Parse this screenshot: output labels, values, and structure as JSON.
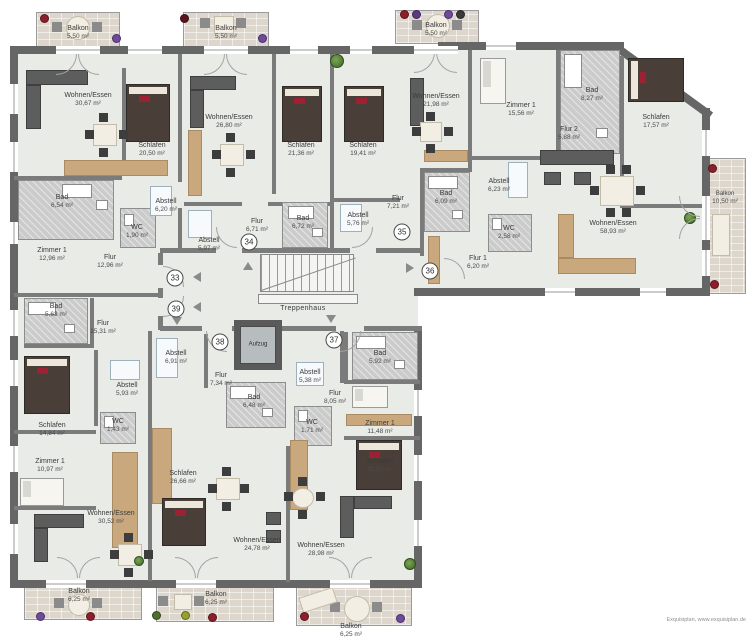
{
  "labels": {
    "stairwell": "Treppenhaus",
    "elevator": "Aufzug",
    "watermark": "Exquisiplan, www.exquisiplan.de"
  },
  "apartment_numbers": [
    "33",
    "39",
    "34",
    "35",
    "36",
    "38",
    "37"
  ],
  "rooms": [
    {
      "name": "Balkon",
      "area": "5,50 m²"
    },
    {
      "name": "Wohnen/Essen",
      "area": "30,67 m²"
    },
    {
      "name": "Schlafen",
      "area": "20,50 m²"
    },
    {
      "name": "Bad",
      "area": "6,54 m²"
    },
    {
      "name": "Zimmer 1",
      "area": "12,96 m²"
    },
    {
      "name": "Flur",
      "area": "12,96 m²"
    },
    {
      "name": "WC",
      "area": "1,90 m²"
    },
    {
      "name": "Abstell",
      "area": "6,20 m²"
    },
    {
      "name": "Balkon",
      "area": "5,50 m²"
    },
    {
      "name": "Wohnen/Essen",
      "area": "26,80 m²"
    },
    {
      "name": "Schlafen",
      "area": "21,36 m²"
    },
    {
      "name": "Abstell",
      "area": "5,97 m²"
    },
    {
      "name": "Flur",
      "area": "6,71 m²"
    },
    {
      "name": "Bad",
      "area": "6,72 m²"
    },
    {
      "name": "Balkon",
      "area": "5,50 m²"
    },
    {
      "name": "Schlafen",
      "area": "19,41 m²"
    },
    {
      "name": "Abstell",
      "area": "5,76 m²"
    },
    {
      "name": "Flur",
      "area": "7,21 m²"
    },
    {
      "name": "Wohnen/Essen",
      "area": "21,98 m²"
    },
    {
      "name": "Zimmer 1",
      "area": "15,56 m²"
    },
    {
      "name": "Bad",
      "area": "8,27 m²"
    },
    {
      "name": "Schlafen",
      "area": "17,57 m²"
    },
    {
      "name": "Flur 2",
      "area": "5,88 m²"
    },
    {
      "name": "Abstell",
      "area": "6,23 m²"
    },
    {
      "name": "Bad",
      "area": "6,09 m²"
    },
    {
      "name": "WC",
      "area": "2,58 m²"
    },
    {
      "name": "Wohnen/Essen",
      "area": "58,93 m²"
    },
    {
      "name": "Flur 1",
      "area": "6,20 m²"
    },
    {
      "name": "Balkon",
      "area": "10,50 m²"
    },
    {
      "name": "Bad",
      "area": "5,63 m²"
    },
    {
      "name": "Flur",
      "area": "15,31 m²"
    },
    {
      "name": "Schlafen",
      "area": "14,84 m²"
    },
    {
      "name": "Abstell",
      "area": "5,93 m²"
    },
    {
      "name": "WC",
      "area": "1,43 m²"
    },
    {
      "name": "Zimmer 1",
      "area": "10,97 m²"
    },
    {
      "name": "Wohnen/Essen",
      "area": "30,52 m²"
    },
    {
      "name": "Balkon",
      "area": "6,25 m²"
    },
    {
      "name": "Abstell",
      "area": "6,91 m²"
    },
    {
      "name": "Flur",
      "area": "7,34 m²"
    },
    {
      "name": "Bad",
      "area": "6,48 m²"
    },
    {
      "name": "WC",
      "area": "1,71 m²"
    },
    {
      "name": "Schlafen",
      "area": "26,66 m²"
    },
    {
      "name": "Wohnen/Essen",
      "area": "24,78 m²"
    },
    {
      "name": "Balkon",
      "area": "6,25 m²"
    },
    {
      "name": "Abstell",
      "area": "5,38 m²"
    },
    {
      "name": "Flur",
      "area": "8,05 m²"
    },
    {
      "name": "Bad",
      "area": "5,92 m²"
    },
    {
      "name": "Zimmer 1",
      "area": "11,48 m²"
    },
    {
      "name": "Schlafen",
      "area": "11,52 m²"
    },
    {
      "name": "Wohnen/Essen",
      "area": "28,98 m²"
    },
    {
      "name": "Balkon",
      "area": "6,25 m²"
    }
  ],
  "colors": {
    "wall": "#666666",
    "floor": "#e9ebe7",
    "balcony_tile": "#dcd6cc",
    "wet_room": "#cbcbcb",
    "bed_accent": "#9c2133"
  }
}
